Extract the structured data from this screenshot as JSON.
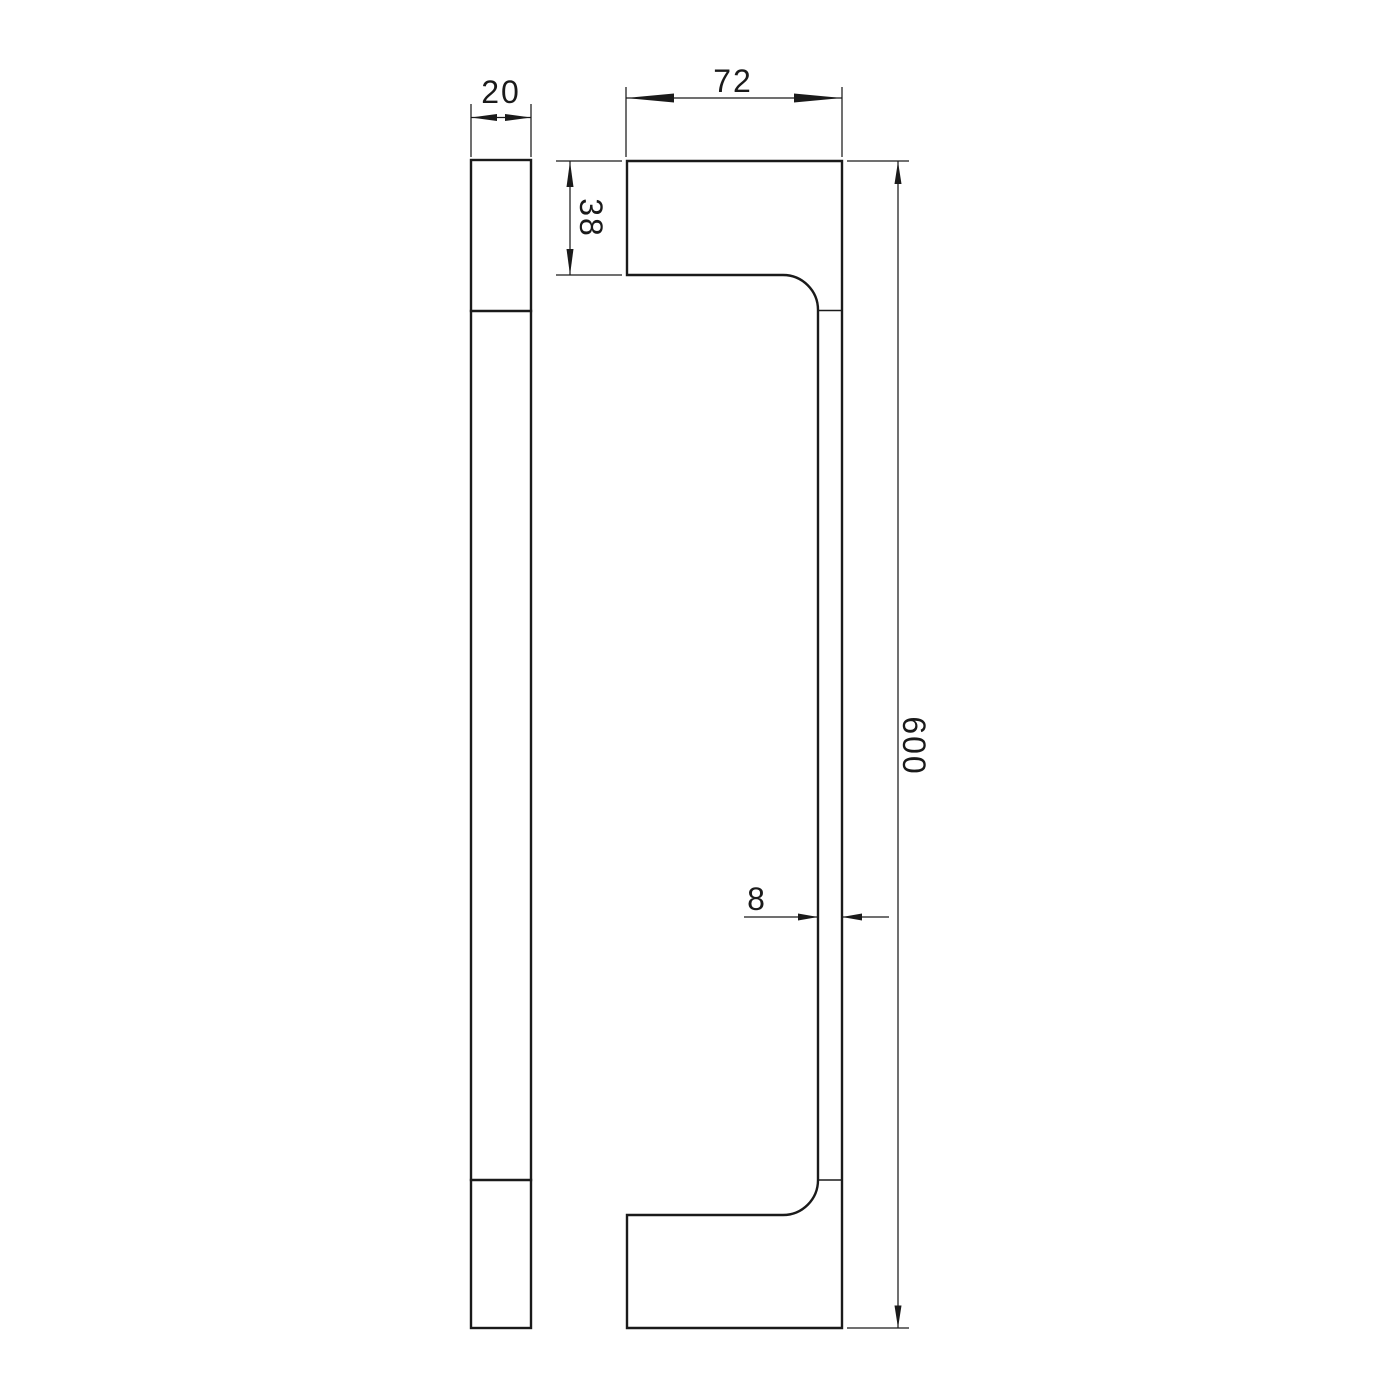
{
  "drawing": {
    "background_color": "#ffffff",
    "line_color": "#1a1a1a",
    "dimensions": {
      "side_thickness": "20",
      "bracket_depth": "72",
      "bracket_height": "38",
      "overall_length": "600",
      "bar_thickness": "8"
    }
  }
}
